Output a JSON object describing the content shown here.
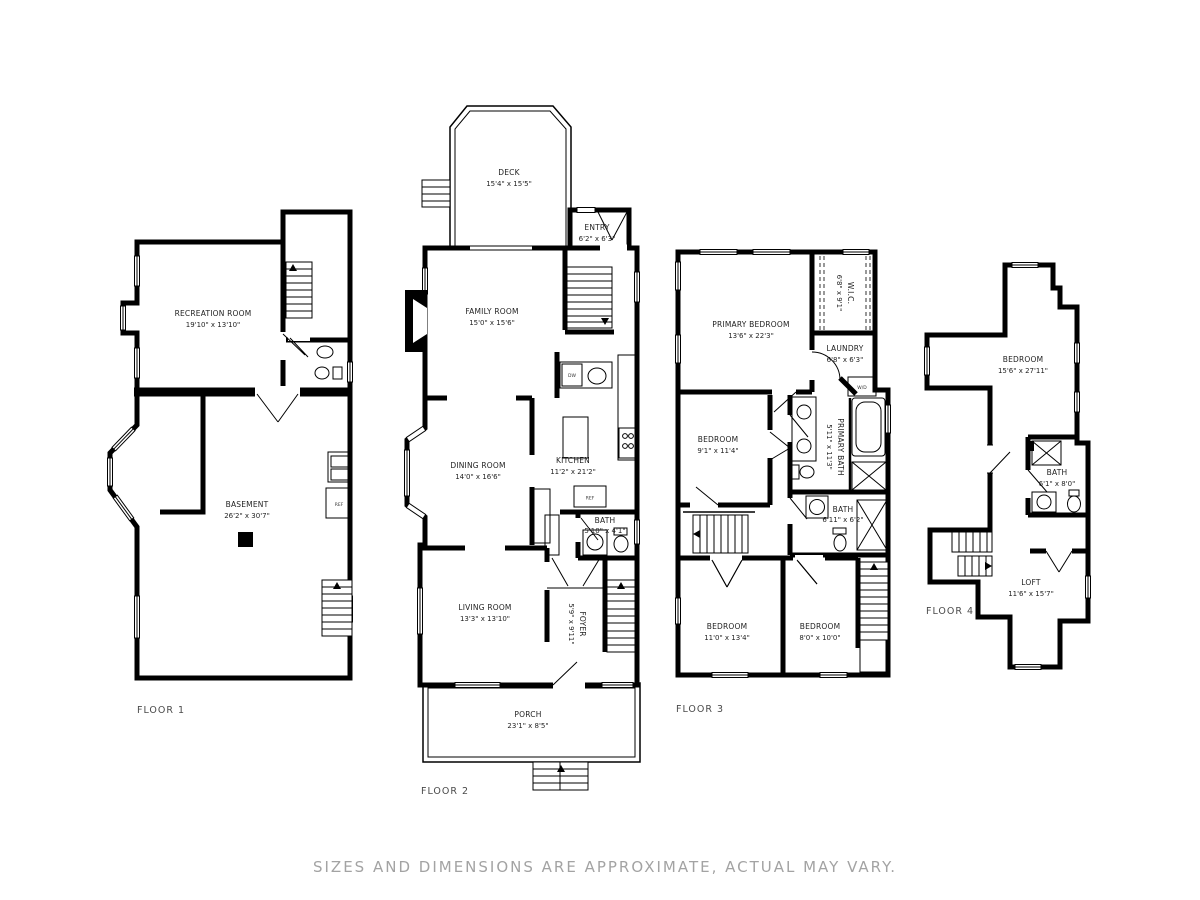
{
  "disclaimer": "SIZES AND DIMENSIONS ARE APPROXIMATE, ACTUAL MAY VARY.",
  "appliances": {
    "refrigerator": "REF",
    "dishwasher": "DW",
    "washer_dryer": "W/D"
  },
  "floors": [
    {
      "label": "FLOOR 1",
      "rooms": [
        {
          "name": "RECREATION ROOM",
          "dims": "19'10\" x 13'10\""
        },
        {
          "name": "BASEMENT",
          "dims": "26'2\" x 30'7\""
        }
      ]
    },
    {
      "label": "FLOOR 2",
      "rooms": [
        {
          "name": "DECK",
          "dims": "15'4\" x 15'5\""
        },
        {
          "name": "ENTRY",
          "dims": "6'2\" x 6'3\""
        },
        {
          "name": "FAMILY ROOM",
          "dims": "15'0\" x 15'6\""
        },
        {
          "name": "DINING ROOM",
          "dims": "14'0\" x 16'6\""
        },
        {
          "name": "KITCHEN",
          "dims": "11'2\" x 21'2\""
        },
        {
          "name": "BATH",
          "dims": "5'10\" x 4'1\""
        },
        {
          "name": "LIVING ROOM",
          "dims": "13'3\" x 13'10\""
        },
        {
          "name": "FOYER",
          "dims": "5'9\" x 9'11\""
        },
        {
          "name": "PORCH",
          "dims": "23'1\" x 8'5\""
        }
      ]
    },
    {
      "label": "FLOOR 3",
      "rooms": [
        {
          "name": "PRIMARY BEDROOM",
          "dims": "13'6\" x 22'3\""
        },
        {
          "name": "W.I.C.",
          "dims": "6'8\" x 9'1\""
        },
        {
          "name": "LAUNDRY",
          "dims": "6'8\" x 6'3\""
        },
        {
          "name": "BEDROOM",
          "dims": "9'1\" x 11'4\""
        },
        {
          "name": "PRIMARY BATH",
          "dims": "5'11\" x 11'3\""
        },
        {
          "name": "BATH",
          "dims": "6'11\" x 6'2\""
        },
        {
          "name": "BEDROOM",
          "dims": "11'0\" x 13'4\""
        },
        {
          "name": "BEDROOM",
          "dims": "8'0\" x 10'0\""
        }
      ]
    },
    {
      "label": "FLOOR 4",
      "rooms": [
        {
          "name": "BEDROOM",
          "dims": "15'6\" x 27'11\""
        },
        {
          "name": "BATH",
          "dims": "6'1\" x 8'0\""
        },
        {
          "name": "LOFT",
          "dims": "11'6\" x 15'7\""
        }
      ]
    }
  ]
}
